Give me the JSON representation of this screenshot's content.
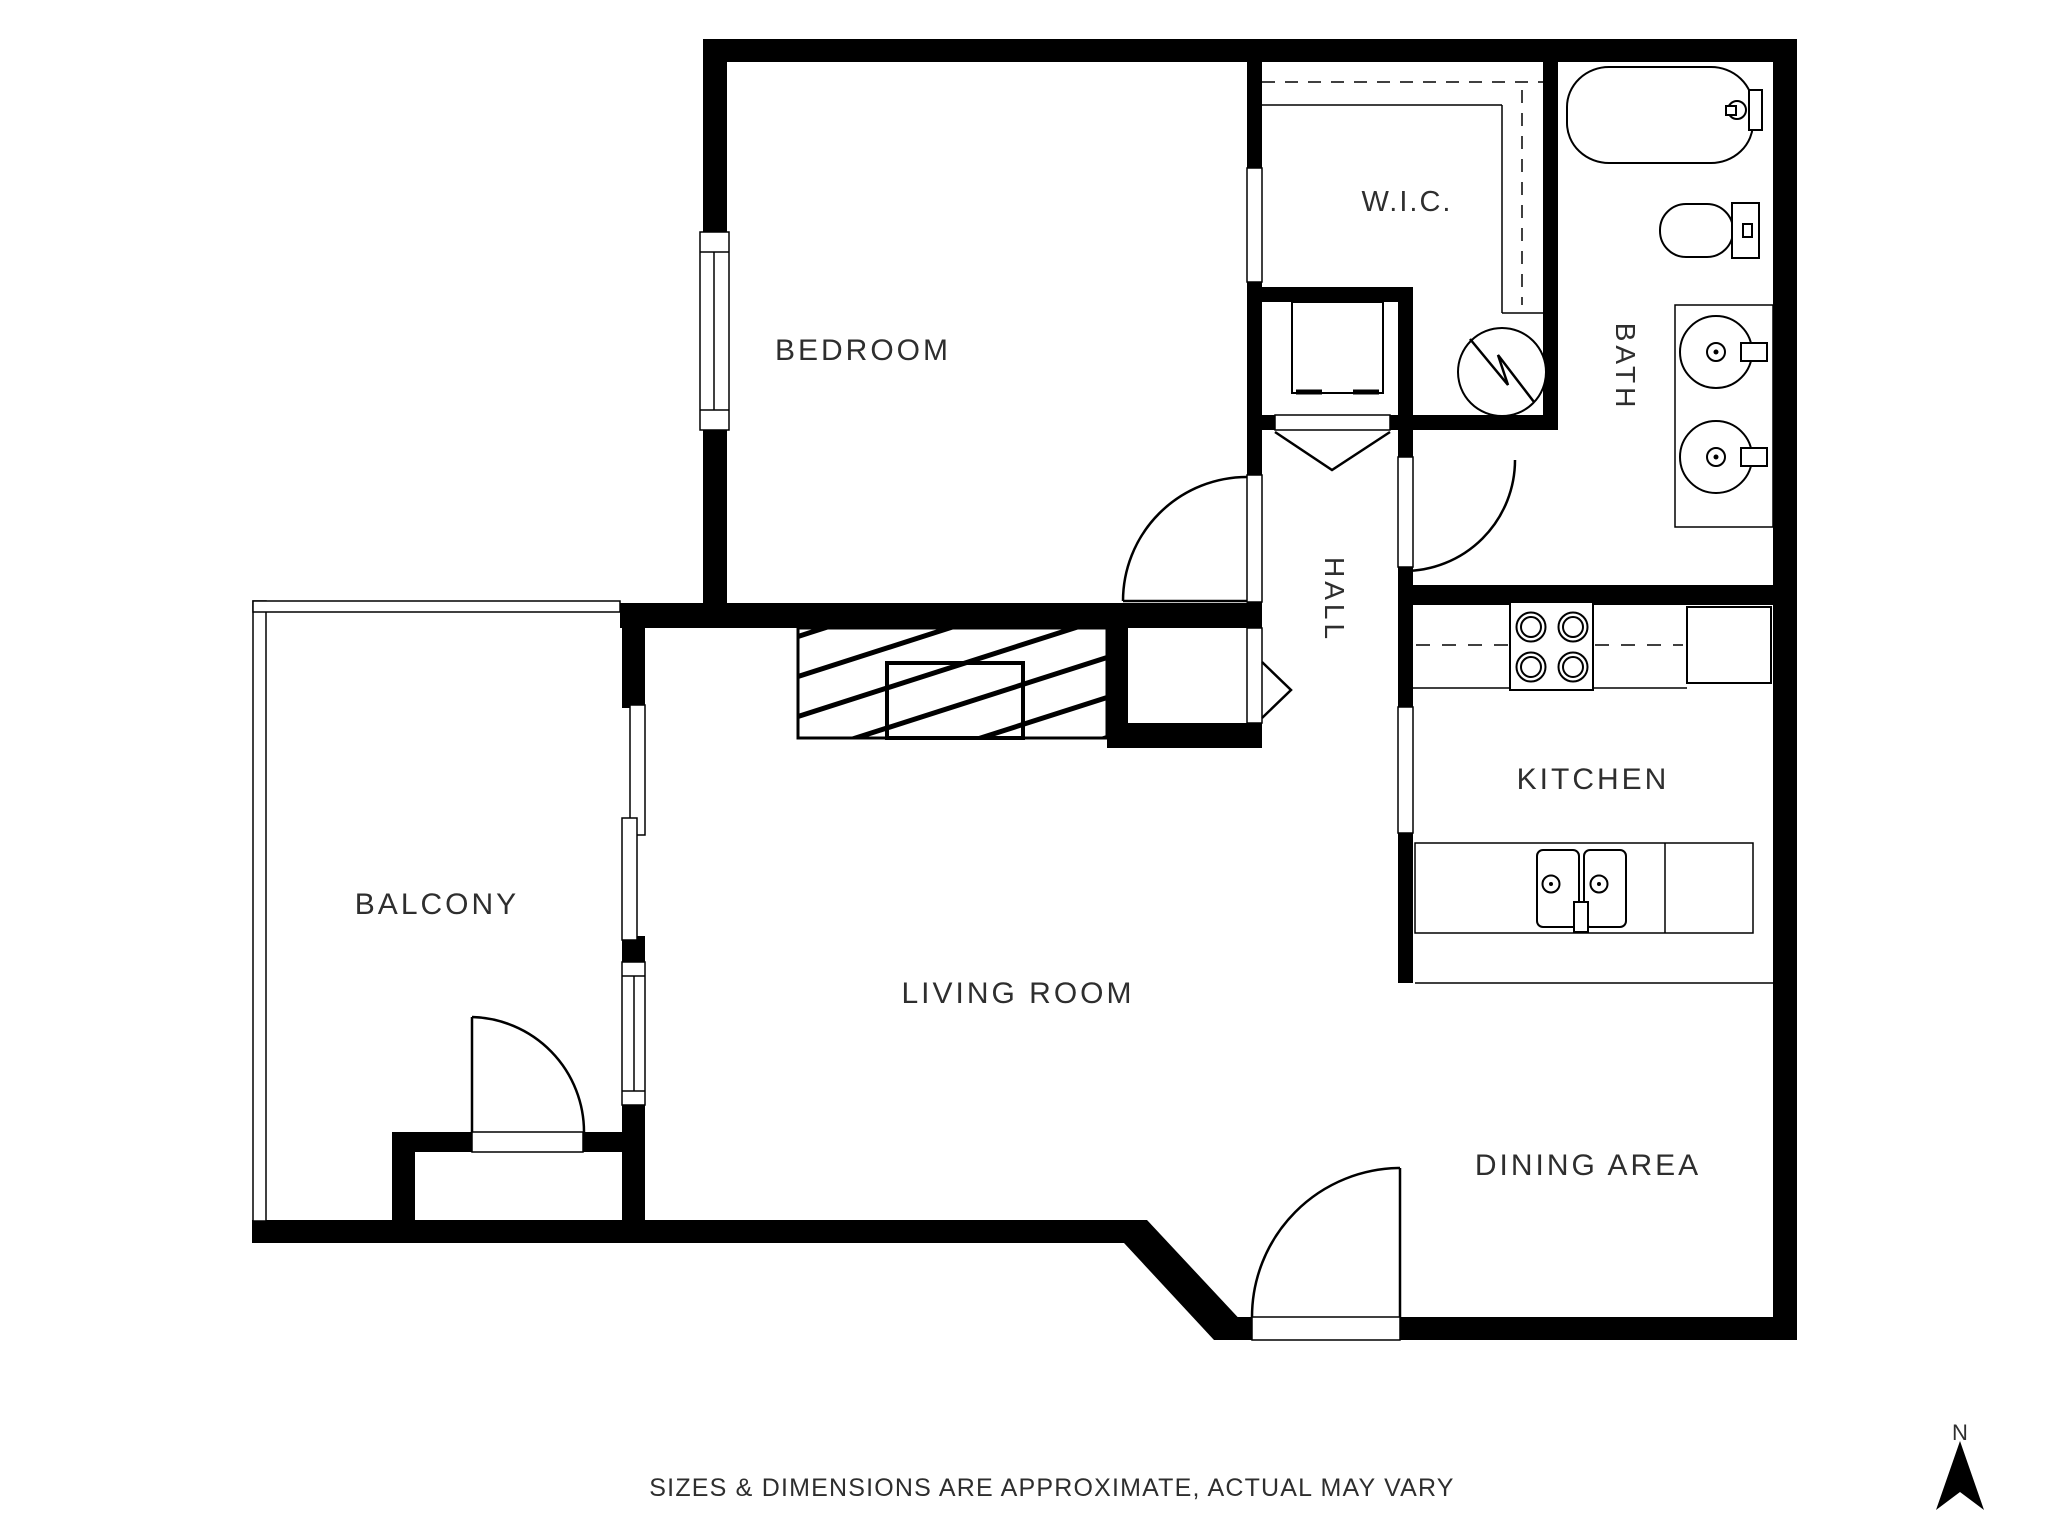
{
  "rooms": {
    "bedroom": "BEDROOM",
    "wic": "W.I.C.",
    "bath": "BATH",
    "hall": "HALL",
    "kitchen": "KITCHEN",
    "balcony": "BALCONY",
    "living_room": "LIVING ROOM",
    "dining_area": "DINING AREA"
  },
  "footer": {
    "disclaimer": "SIZES & DIMENSIONS ARE APPROXIMATE, ACTUAL MAY VARY"
  },
  "compass": {
    "north_label": "N"
  },
  "colors": {
    "wall": "#000000",
    "background": "#ffffff",
    "text": "#2e2e2e"
  },
  "fixtures": {
    "bathtub": "bathtub-icon",
    "toilet": "toilet-icon",
    "vanity_sinks": "double-vanity-sink-icon",
    "water_heater": "water-heater-icon",
    "laundry_unit": "laundry-closet-unit-icon",
    "stove": "stove-4-burner-icon",
    "refrigerator": "refrigerator-icon",
    "kitchen_sink": "double-kitchen-sink-icon",
    "fireplace": "fireplace-icon",
    "north_arrow": "north-arrow-icon"
  }
}
